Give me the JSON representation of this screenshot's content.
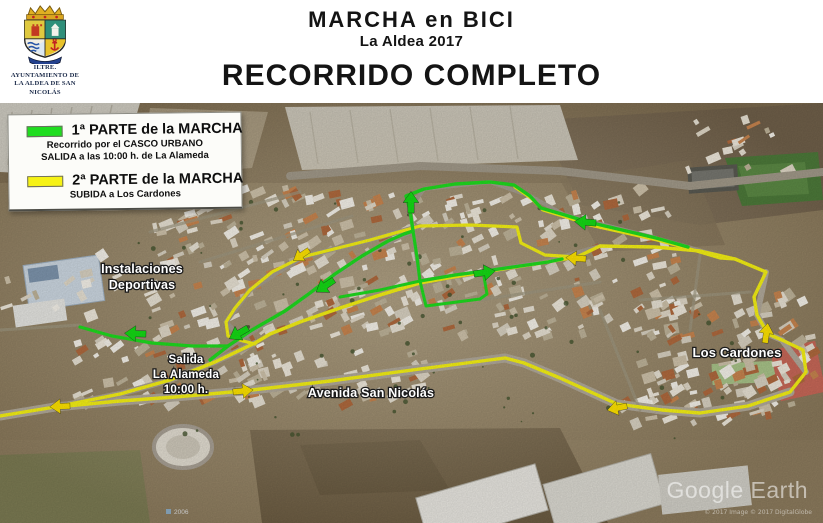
{
  "colors": {
    "part1_green": "#1fdd1f",
    "part2_yellow": "#f6f215",
    "arrow_green": "#15dc15",
    "arrow_yellow": "#ffe400"
  },
  "header": {
    "logo_caption_line1": "ILTRE. AYUNTAMIENTO DE",
    "logo_caption_line2": "LA ALDEA DE SAN NICOLÁS",
    "title": "MARCHA en BICI",
    "subtitle": "La Aldea 2017",
    "heading2": "RECORRIDO COMPLETO"
  },
  "legend": {
    "part1": {
      "title": "1ª PARTE de la MARCHA",
      "desc1": "Recorrido por el CASCO URBANO",
      "desc2": "SALIDA  a las 10:00 h. de La Alameda"
    },
    "part2": {
      "title": "2ª PARTE de la MARCHA",
      "desc1": "SUBIDA a Los Cardones"
    }
  },
  "map": {
    "labels": {
      "instalaciones_line1": "Instalaciones",
      "instalaciones_line2": "Deportivas",
      "salida_line1": "Salida",
      "salida_line2": "La Alameda",
      "salida_line3": "10:00 h.",
      "avenida": "Avenida San Nicolás",
      "los_cardones": "Los Cardones"
    },
    "watermark": "Google Earth",
    "attribution": "© 2017   Image © 2017 DigitalGlobe",
    "imagery_year": "2006"
  }
}
